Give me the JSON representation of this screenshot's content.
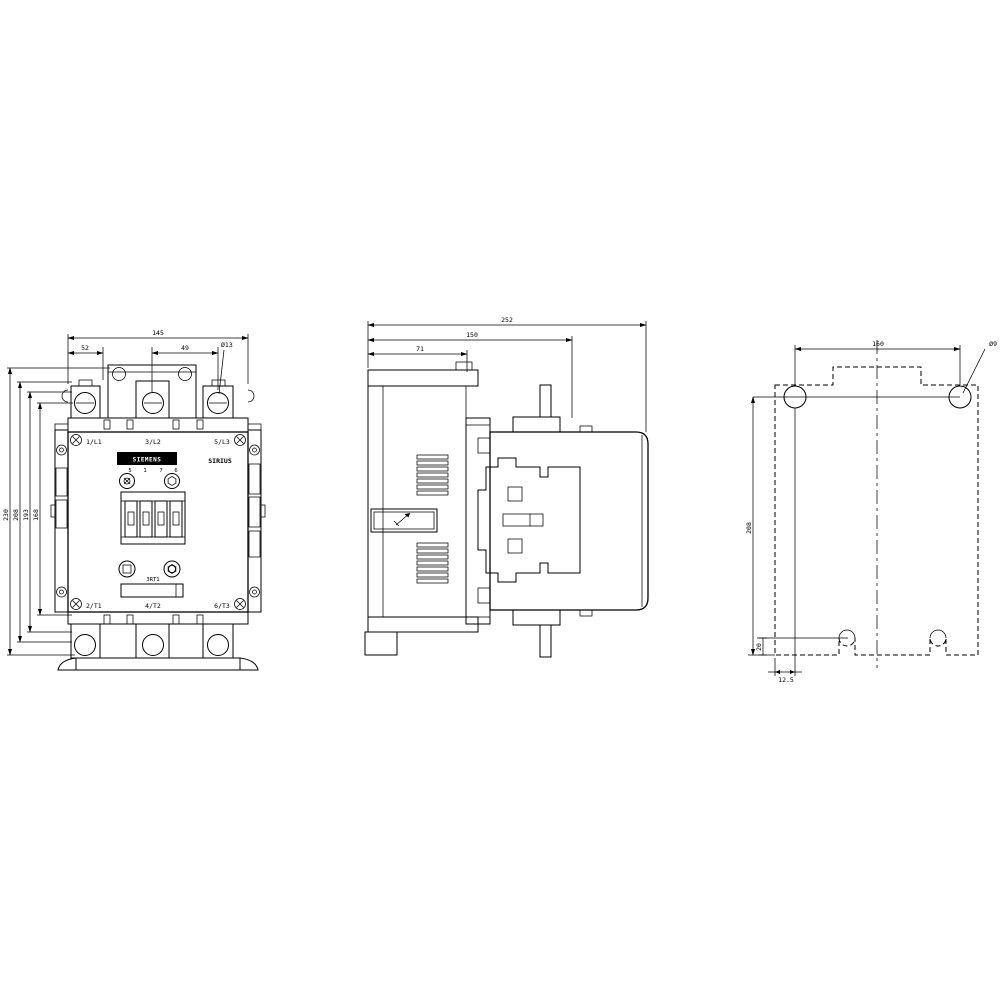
{
  "front": {
    "brand": "SIEMENS",
    "series": "SIRIUS",
    "model": "3RT1",
    "coil_pins": [
      "5",
      "1",
      "7",
      "6"
    ],
    "terminals_top": [
      "1/L1",
      "3/L2",
      "5/L3"
    ],
    "terminals_bottom": [
      "2/T1",
      "4/T2",
      "6/T3"
    ],
    "dim_overall_width": "145",
    "dim_pitch_left": "52",
    "dim_pitch_right": "49",
    "dim_terminal_hole": "Ø13",
    "dim_height_1": "230",
    "dim_height_2": "208",
    "dim_height_3": "193",
    "dim_height_4": "168"
  },
  "side": {
    "dim_depth_overall": "252",
    "dim_depth_rear": "150",
    "dim_depth_flange": "71"
  },
  "plan": {
    "dim_hole_spacing_h": "160",
    "dim_hole_spacing_v": "208",
    "dim_slot_height": "20",
    "dim_edge_offset": "12.5",
    "dim_hole_callout": "Ø9"
  },
  "colors": {
    "line": "#000000",
    "background": "#ffffff"
  }
}
